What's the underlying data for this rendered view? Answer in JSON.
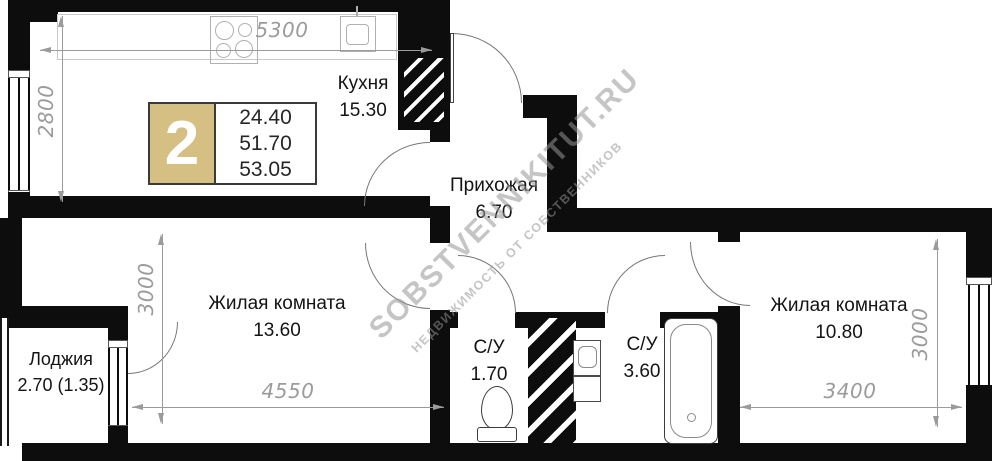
{
  "badge": {
    "rooms_count": "2",
    "area_living": "24.40",
    "area_usable": "51.70",
    "area_total": "53.05",
    "accent_color": "#d6bf82"
  },
  "rooms": [
    {
      "id": "kitchen",
      "name": "Кухня",
      "area": "15.30"
    },
    {
      "id": "hallway",
      "name": "Прихожая",
      "area": "6.70"
    },
    {
      "id": "living1",
      "name": "Жилая комната",
      "area": "13.60"
    },
    {
      "id": "living2",
      "name": "Жилая комната",
      "area": "10.80"
    },
    {
      "id": "loggia",
      "name": "Лоджия",
      "area": "2.70 (1.35)"
    },
    {
      "id": "wc1",
      "name": "С/У",
      "area": "1.70"
    },
    {
      "id": "wc2",
      "name": "С/У",
      "area": "3.60"
    }
  ],
  "dimensions": {
    "top_kitchen": "5300",
    "left_kitchen": "2800",
    "left_living": "3000",
    "bottom_living1": "4550",
    "bottom_living2": "3400",
    "right_living2": "3000"
  },
  "watermark": {
    "line1": "SOBSTVENNIKITUT.RU",
    "line2": "НЕДВИЖИМОСТЬ ОТ СОБСТВЕННИКОВ"
  },
  "fixtures": [
    "stove-icon",
    "kitchen-sink-icon",
    "toilet-icon",
    "washbasin-icon",
    "bathtub-icon",
    "vent-shaft-hatch"
  ],
  "colors": {
    "wall": "#0d0d0d",
    "dimension": "#9b9b9b",
    "badge_tan": "#d6bf82",
    "watermark": "#969696"
  }
}
